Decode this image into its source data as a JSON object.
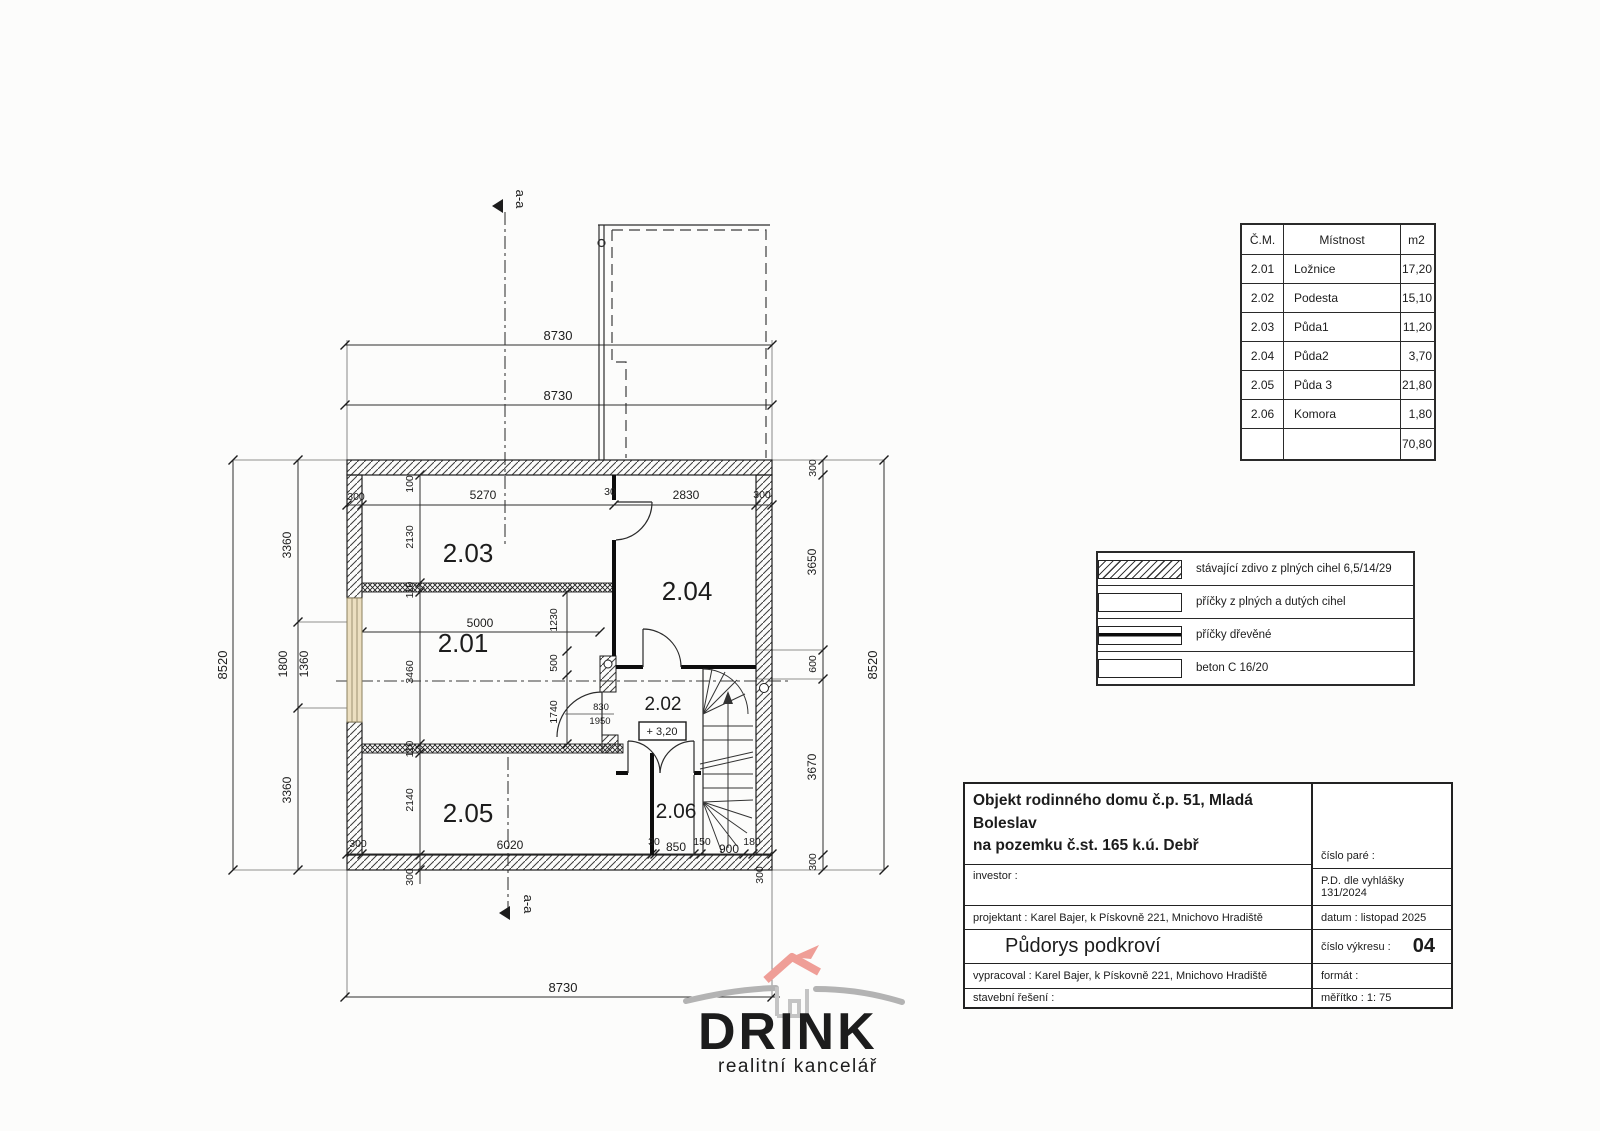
{
  "plan": {
    "rooms": {
      "r201": "2.01",
      "r202": "2.02",
      "r203": "2.03",
      "r204": "2.04",
      "r205": "2.05",
      "r206": "2.06"
    },
    "section_label_top": "a-a",
    "section_label_bottom": "a-a",
    "level_label": "+ 3,20",
    "door_label_width": "830",
    "door_label_height": "1950",
    "dims": {
      "top_a": "8730",
      "top_b": "8730",
      "bottom": "8730",
      "left_overall": "8520",
      "left_1": "3360",
      "left_2": "1800",
      "left_2b": "1360",
      "left_3": "3360",
      "right_1": "300",
      "right_2": "3650",
      "right_3": "600",
      "right_4": "3670",
      "right_5": "300",
      "right_overall": "8520",
      "in_top_1": "300",
      "in_top_2": "5270",
      "in_top_3": "30",
      "in_top_4": "2830",
      "in_top_5": "300",
      "v_1": "100",
      "v_2": "2130",
      "v_3": "110",
      "v_4": "3460",
      "v_5": "110",
      "v_6": "2140",
      "v_7": "300",
      "w_5000": "5000",
      "v_1230": "1230",
      "v_500": "500",
      "v_1740": "1740",
      "b_1": "300",
      "b_2": "6020",
      "b_3": "30",
      "b_4": "850",
      "b_5": "150",
      "b_6": "900",
      "b_7": "180",
      "b_8": "300"
    }
  },
  "room_table": {
    "headers": {
      "num": "Č.M.",
      "name": "Místnost",
      "area": "m2"
    },
    "rows": [
      {
        "num": "2.01",
        "name": "Ložnice",
        "area": "17,20"
      },
      {
        "num": "2.02",
        "name": "Podesta",
        "area": "15,10"
      },
      {
        "num": "2.03",
        "name": "Půda1",
        "area": "11,20"
      },
      {
        "num": "2.04",
        "name": "Půda2",
        "area": "3,70"
      },
      {
        "num": "2.05",
        "name": "Půda 3",
        "area": "21,80"
      },
      {
        "num": "2.06",
        "name": "Komora",
        "area": "1,80"
      }
    ],
    "total_area": "70,80"
  },
  "legend": {
    "items": [
      {
        "label": "stávající zdivo z plných cihel 6,5/14/29",
        "swatch": "brick-hatch"
      },
      {
        "label": "příčky z plných a dutých cihel",
        "swatch": "cross-hatch"
      },
      {
        "label": "příčky dřevěné",
        "swatch": "wood-line"
      },
      {
        "label": "beton C 16/20",
        "swatch": "concrete-hatch"
      }
    ]
  },
  "title_block": {
    "project_line1": "Objekt rodinného domu č.p. 51, Mladá Boleslav",
    "project_line2": "na pozemku č.st. 165 k.ú. Debř",
    "investor_label": "investor :",
    "projektant": "projektant : Karel Bajer, k Pískovně 221, Mnichovo Hradiště",
    "drawing_title": "Půdorys podkroví",
    "vypracoval": "vypracoval : Karel Bajer, k Pískovně 221, Mnichovo Hradiště",
    "stavebni": "stavební řešení :",
    "cislo_pare": "číslo paré :",
    "pd": "P.D. dle vyhlášky 131/2024",
    "datum": "datum : listopad 2025",
    "cislo_vykresu_label": "číslo výkresu :",
    "cislo_vykresu": "04",
    "format_label": "formát :",
    "meritko": "měřítko :  1: 75"
  },
  "logo": {
    "name": "DRINK",
    "subtitle": "realitní kancelář"
  }
}
